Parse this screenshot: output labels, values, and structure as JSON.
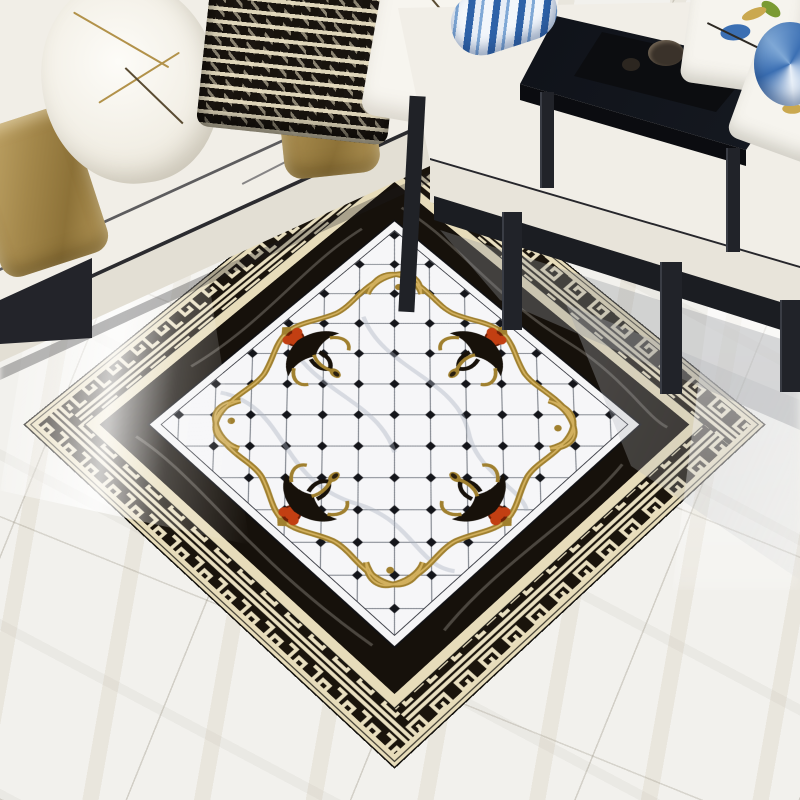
{
  "scene": {
    "type": "product-photo",
    "subject": "glossy marble baroque floor-tile carpet mural in a living room",
    "room": {
      "floor": "white marble tiles with faint beige veins and diagonal seams",
      "left_sofa": {
        "style": "white fabric sofa with black piping",
        "pillows": [
          {
            "name": "gold-satin-pillow"
          },
          {
            "name": "white-pillow-gold-branch-embroidery"
          },
          {
            "name": "black-white-geometric-pillow"
          },
          {
            "name": "gold-satin-pillow-2"
          },
          {
            "name": "white-pillow-floral-sprigs"
          }
        ]
      },
      "right_daybed": {
        "style": "black wood chinese daybed with white cushion",
        "items": [
          {
            "name": "blue-porcelain-bolster"
          },
          {
            "name": "bird-embroidery-pillow"
          },
          {
            "name": "floral-embroidery-pillow"
          },
          {
            "name": "blue-round-cushion"
          },
          {
            "name": "black-tea-table"
          },
          {
            "name": "tea-set"
          }
        ]
      }
    },
    "rug": {
      "style": "baroque marble inlay mural",
      "outer_trim": "cream marble pinstriped band",
      "border_pattern": "greek-key meander, cream on black",
      "inner_border": "black marble band with light veins",
      "field": "white marble diamond grid with black diamond dot inlays",
      "frame": "gold scalloped baroque frame with corner scrolls",
      "ornaments": {
        "motif": "fleur-de-lis",
        "count": 4,
        "colors": [
          "gold",
          "black",
          "red-orange"
        ]
      },
      "finish": "high-gloss with window reflection glare"
    }
  },
  "colors": {
    "floor": "#f2f1ed",
    "cream": "#e7dcba",
    "band-black": "#1a140c",
    "key-cream": "#e9dfc0",
    "border-black": "#16110b",
    "field": "#f6f6f8",
    "grid-line": "#7a7f88",
    "dot": "#14151a",
    "gold": "#a0802f",
    "gold-light": "#d2b05e",
    "red": "#c23f12",
    "sofa": "#f1eee7",
    "sofa-face": "#e3dfd4",
    "piping": "#2b2b2f",
    "wood": "#1b1d22",
    "blue": "#3b6fb3",
    "green": "#7a9a33"
  }
}
